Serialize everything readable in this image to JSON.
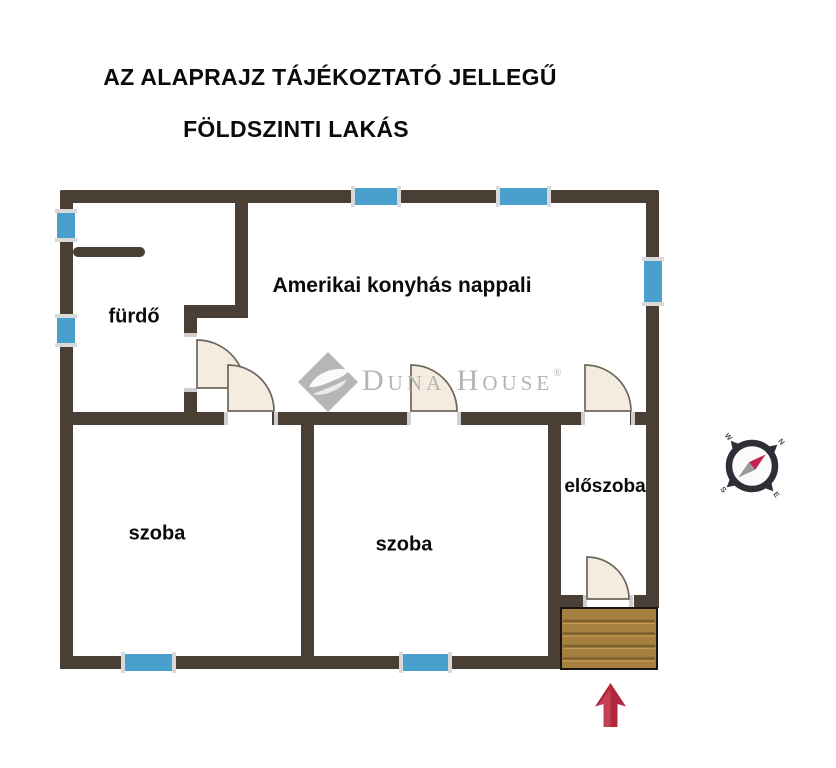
{
  "title": {
    "line1": "AZ ALAPRAJZ TÁJÉKOZTATÓ JELLEGŰ",
    "line2": "FÖLDSZINTI LAKÁS"
  },
  "rooms": {
    "living": "Amerikai konyhás nappali",
    "bathroom": "fürdő",
    "room1": "szoba",
    "room2": "szoba",
    "hall": "előszoba"
  },
  "watermark": {
    "word1": "Duna",
    "word2": "House",
    "reg": "®",
    "gray": "#b6b6b6"
  },
  "compass": {
    "n": "N",
    "e": "E",
    "s": "S",
    "w": "W"
  },
  "colors": {
    "wall": "#4a3f35",
    "window": "#4aa0cc",
    "window_cap": "#d9d9d9",
    "door_fill": "#f4ecdf",
    "door_stroke": "#6e655a",
    "door_jamb": "#cfcfcf",
    "wood": "#a5803f",
    "wood_line": "#7c5f2e",
    "wood_line_light": "#c9a055",
    "arrow_red": "#b1273c",
    "arrow_light": "#d2566a",
    "compass_ring": "#2e2e36",
    "compass_face": "#fafafa",
    "compass_needle_red": "#c22553",
    "compass_needle_gray": "#9b9b9b",
    "compass_letter": "#4a4a4a"
  }
}
